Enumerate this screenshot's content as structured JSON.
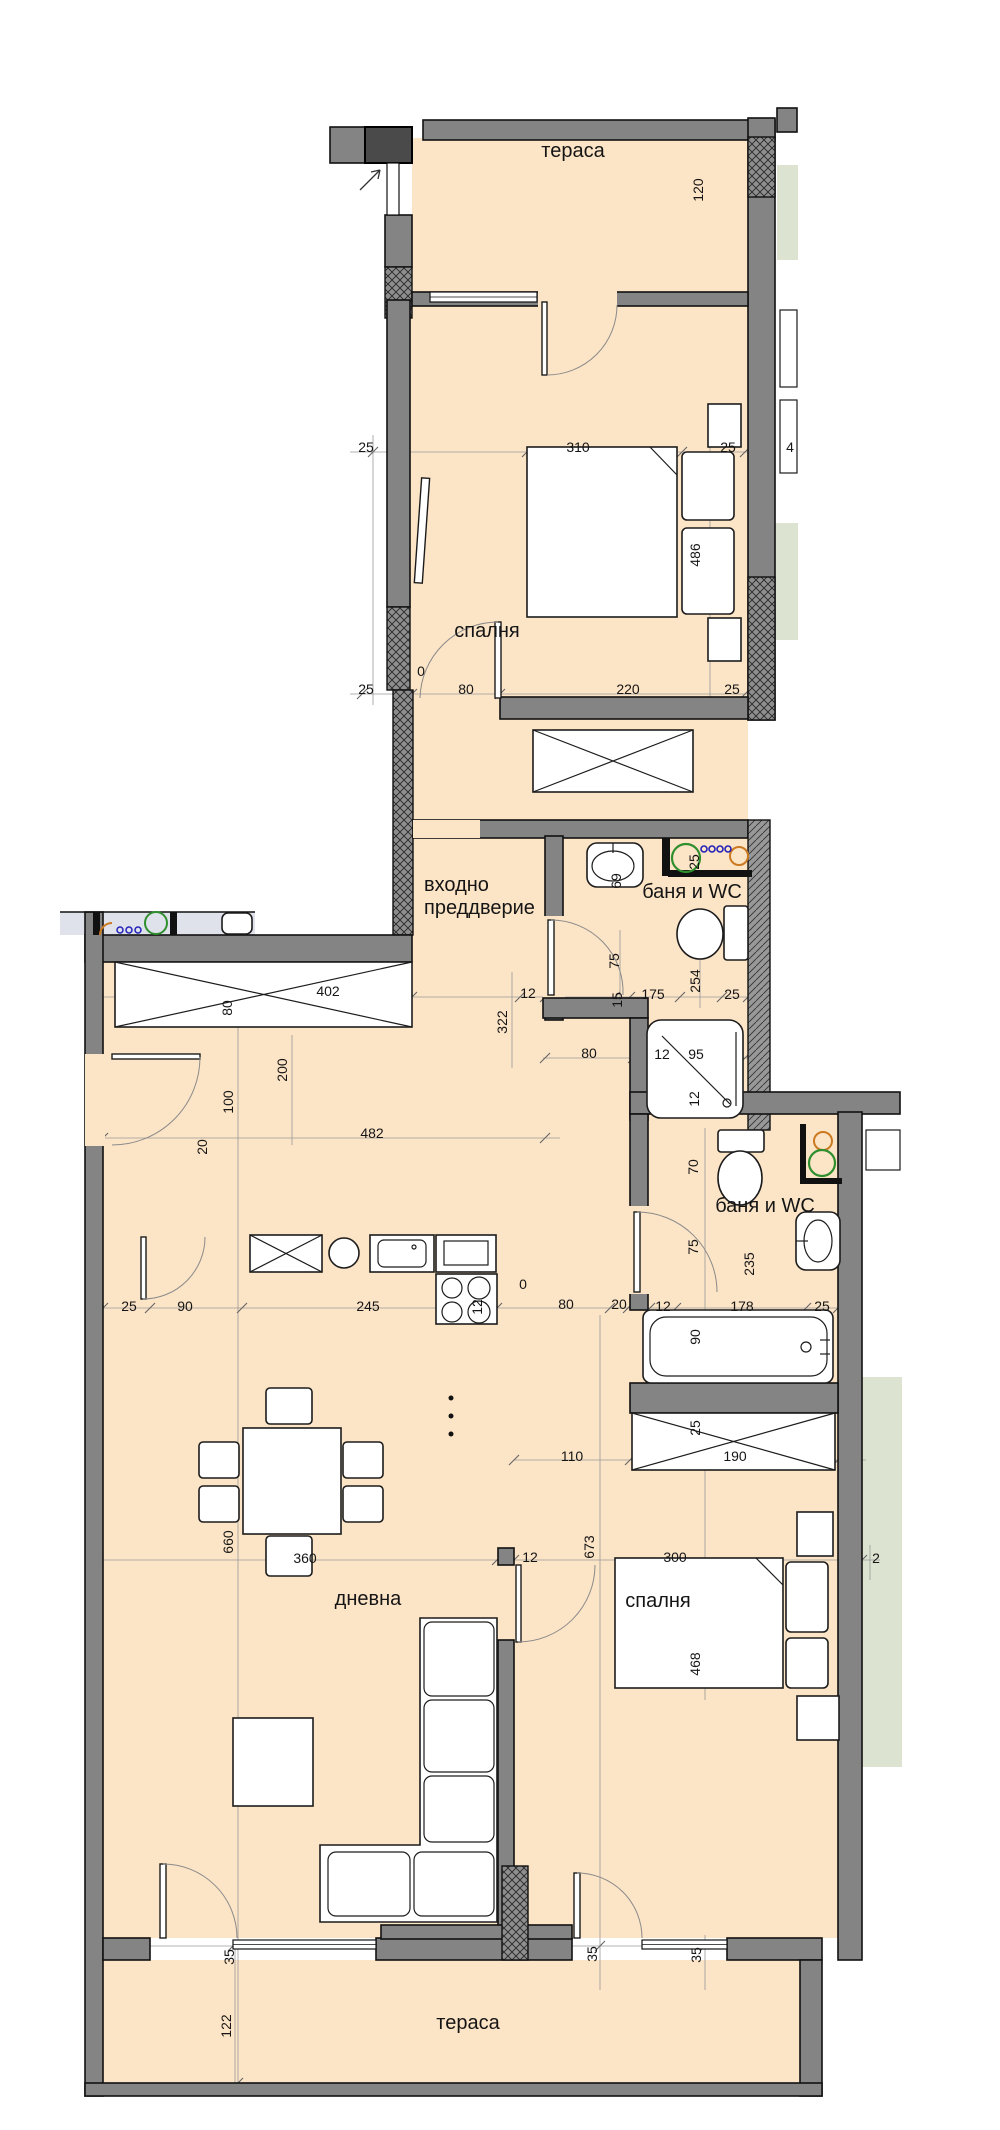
{
  "plan": {
    "title": "apartment-floor-plan",
    "colors": {
      "floor": "#fce4c6",
      "wall": "#848484",
      "neighbor_floor_blue": "#e0e2eb",
      "neighbor_floor_green": "#dce3d0",
      "washing_machine_green": "#2f8f2f",
      "washing_machine_orange": "#cc7a22",
      "dots_blue": "#2222bb",
      "line_black": "#111111"
    },
    "room_labels": [
      {
        "text": "тераса",
        "x": 573,
        "y": 157,
        "anchor": "middle"
      },
      {
        "text": "спалня",
        "x": 487,
        "y": 637,
        "anchor": "middle"
      },
      {
        "text": "входно",
        "x": 424,
        "y": 891,
        "anchor": "start"
      },
      {
        "text": "преддверие",
        "x": 424,
        "y": 914,
        "anchor": "start"
      },
      {
        "text": "баня и WC",
        "x": 692,
        "y": 898,
        "anchor": "middle"
      },
      {
        "text": "баня и WC",
        "x": 765,
        "y": 1212,
        "anchor": "middle"
      },
      {
        "text": "дневна",
        "x": 368,
        "y": 1605,
        "anchor": "middle"
      },
      {
        "text": "спалня",
        "x": 658,
        "y": 1607,
        "anchor": "middle"
      },
      {
        "text": "тераса",
        "x": 468,
        "y": 2029,
        "anchor": "middle"
      }
    ],
    "dimensions": [
      {
        "v": "120",
        "x": 703,
        "y": 190,
        "rot": true
      },
      {
        "v": "310",
        "x": 578,
        "y": 452,
        "rot": false
      },
      {
        "v": "25",
        "x": 728,
        "y": 452,
        "rot": false
      },
      {
        "v": "25",
        "x": 366,
        "y": 452,
        "rot": false
      },
      {
        "v": "4",
        "x": 790,
        "y": 452,
        "rot": false
      },
      {
        "v": "486",
        "x": 700,
        "y": 555,
        "rot": true
      },
      {
        "v": "25",
        "x": 366,
        "y": 694,
        "rot": false
      },
      {
        "v": "0",
        "x": 421,
        "y": 676,
        "rot": false
      },
      {
        "v": "80",
        "x": 466,
        "y": 694,
        "rot": false
      },
      {
        "v": "220",
        "x": 628,
        "y": 694,
        "rot": false
      },
      {
        "v": "25",
        "x": 732,
        "y": 694,
        "rot": false
      },
      {
        "v": "69",
        "x": 621,
        "y": 881,
        "rot": true
      },
      {
        "v": "25",
        "x": 699,
        "y": 862,
        "rot": true
      },
      {
        "v": "75",
        "x": 619,
        "y": 961,
        "rot": true
      },
      {
        "v": "254",
        "x": 700,
        "y": 981,
        "rot": true
      },
      {
        "v": "12",
        "x": 528,
        "y": 998,
        "rot": false
      },
      {
        "v": "175",
        "x": 653,
        "y": 999,
        "rot": false
      },
      {
        "v": "25",
        "x": 732,
        "y": 999,
        "rot": false
      },
      {
        "v": "15",
        "x": 622,
        "y": 1000,
        "rot": true
      },
      {
        "v": "322",
        "x": 507,
        "y": 1022,
        "rot": true
      },
      {
        "v": "402",
        "x": 328,
        "y": 996,
        "rot": false
      },
      {
        "v": "80",
        "x": 232,
        "y": 1008,
        "rot": true
      },
      {
        "v": "200",
        "x": 287,
        "y": 1070,
        "rot": true
      },
      {
        "v": "100",
        "x": 233,
        "y": 1102,
        "rot": true
      },
      {
        "v": "482",
        "x": 372,
        "y": 1138,
        "rot": false
      },
      {
        "v": "20",
        "x": 207,
        "y": 1147,
        "rot": true
      },
      {
        "v": "80",
        "x": 589,
        "y": 1058,
        "rot": false
      },
      {
        "v": "12",
        "x": 662,
        "y": 1059,
        "rot": false
      },
      {
        "v": "95",
        "x": 696,
        "y": 1059,
        "rot": false
      },
      {
        "v": "12",
        "x": 699,
        "y": 1099,
        "rot": true
      },
      {
        "v": "70",
        "x": 698,
        "y": 1167,
        "rot": true
      },
      {
        "v": "75",
        "x": 698,
        "y": 1247,
        "rot": true
      },
      {
        "v": "235",
        "x": 754,
        "y": 1264,
        "rot": true
      },
      {
        "v": "25",
        "x": 129,
        "y": 1311,
        "rot": false
      },
      {
        "v": "90",
        "x": 185,
        "y": 1311,
        "rot": false
      },
      {
        "v": "245",
        "x": 368,
        "y": 1311,
        "rot": false
      },
      {
        "v": "12",
        "x": 482,
        "y": 1307,
        "rot": true
      },
      {
        "v": "0",
        "x": 523,
        "y": 1289,
        "rot": false
      },
      {
        "v": "80",
        "x": 566,
        "y": 1309,
        "rot": false
      },
      {
        "v": "20",
        "x": 619,
        "y": 1309,
        "rot": false
      },
      {
        "v": "12",
        "x": 663,
        "y": 1311,
        "rot": false
      },
      {
        "v": "178",
        "x": 742,
        "y": 1311,
        "rot": false
      },
      {
        "v": "25",
        "x": 822,
        "y": 1311,
        "rot": false
      },
      {
        "v": "90",
        "x": 700,
        "y": 1337,
        "rot": true
      },
      {
        "v": "110",
        "x": 572,
        "y": 1461,
        "rot": false
      },
      {
        "v": "190",
        "x": 735,
        "y": 1461,
        "rot": false
      },
      {
        "v": "25",
        "x": 700,
        "y": 1428,
        "rot": true
      },
      {
        "v": "660",
        "x": 233,
        "y": 1542,
        "rot": true
      },
      {
        "v": "360",
        "x": 305,
        "y": 1563,
        "rot": false
      },
      {
        "v": "12",
        "x": 530,
        "y": 1562,
        "rot": false
      },
      {
        "v": "673",
        "x": 594,
        "y": 1547,
        "rot": true
      },
      {
        "v": "300",
        "x": 675,
        "y": 1562,
        "rot": false
      },
      {
        "v": "2",
        "x": 876,
        "y": 1563,
        "rot": false
      },
      {
        "v": "468",
        "x": 700,
        "y": 1664,
        "rot": true
      },
      {
        "v": "35",
        "x": 234,
        "y": 1957,
        "rot": true
      },
      {
        "v": "35",
        "x": 597,
        "y": 1954,
        "rot": true
      },
      {
        "v": "35",
        "x": 701,
        "y": 1955,
        "rot": true
      },
      {
        "v": "122",
        "x": 231,
        "y": 2026,
        "rot": true
      }
    ]
  }
}
